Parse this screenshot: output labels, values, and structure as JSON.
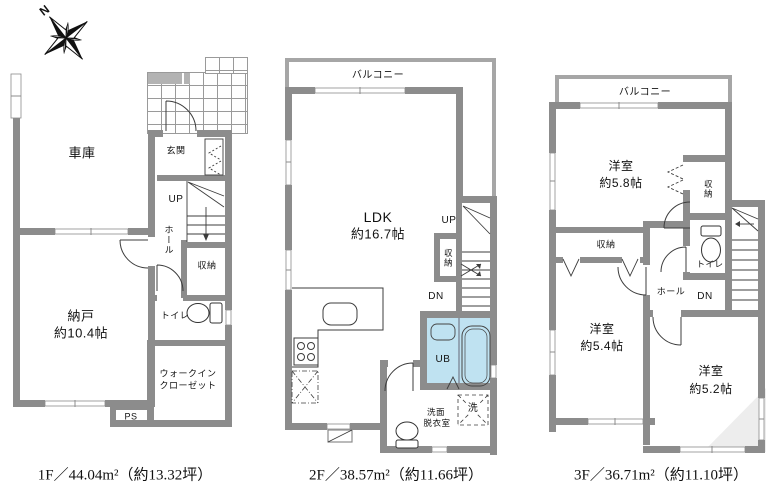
{
  "compass": {
    "north": "N"
  },
  "floor1": {
    "caption": "1F／44.04m²（約13.32坪）",
    "garage": "車庫",
    "genkan": "玄関",
    "up": "UP",
    "hall": "ホール",
    "storage": "収納",
    "toilet": "トイレ",
    "nando_line1": "納戸",
    "nando_line2": "約10.4帖",
    "wic_line1": "ウォークイン",
    "wic_line2": "クローゼット",
    "ps": "PS"
  },
  "floor2": {
    "caption": "2F／38.57m²（約11.66坪）",
    "balcony": "バルコニー",
    "ldk_line1": "LDK",
    "ldk_line2": "約16.7帖",
    "up": "UP",
    "dn": "DN",
    "storage": "収納",
    "ub": "UB",
    "laundry": "洗",
    "wash_line1": "洗面",
    "wash_line2": "脱衣室"
  },
  "floor3": {
    "caption": "3F／36.71m²（約11.10坪）",
    "balcony": "バルコニー",
    "room58_line1": "洋室",
    "room58_line2": "約5.8帖",
    "room54_line1": "洋室",
    "room54_line2": "約5.4帖",
    "room52_line1": "洋室",
    "room52_line2": "約5.2帖",
    "storage_v": "収納",
    "storage_h": "収納",
    "toilet": "トイレ",
    "hall": "ホール",
    "dn": "DN"
  }
}
